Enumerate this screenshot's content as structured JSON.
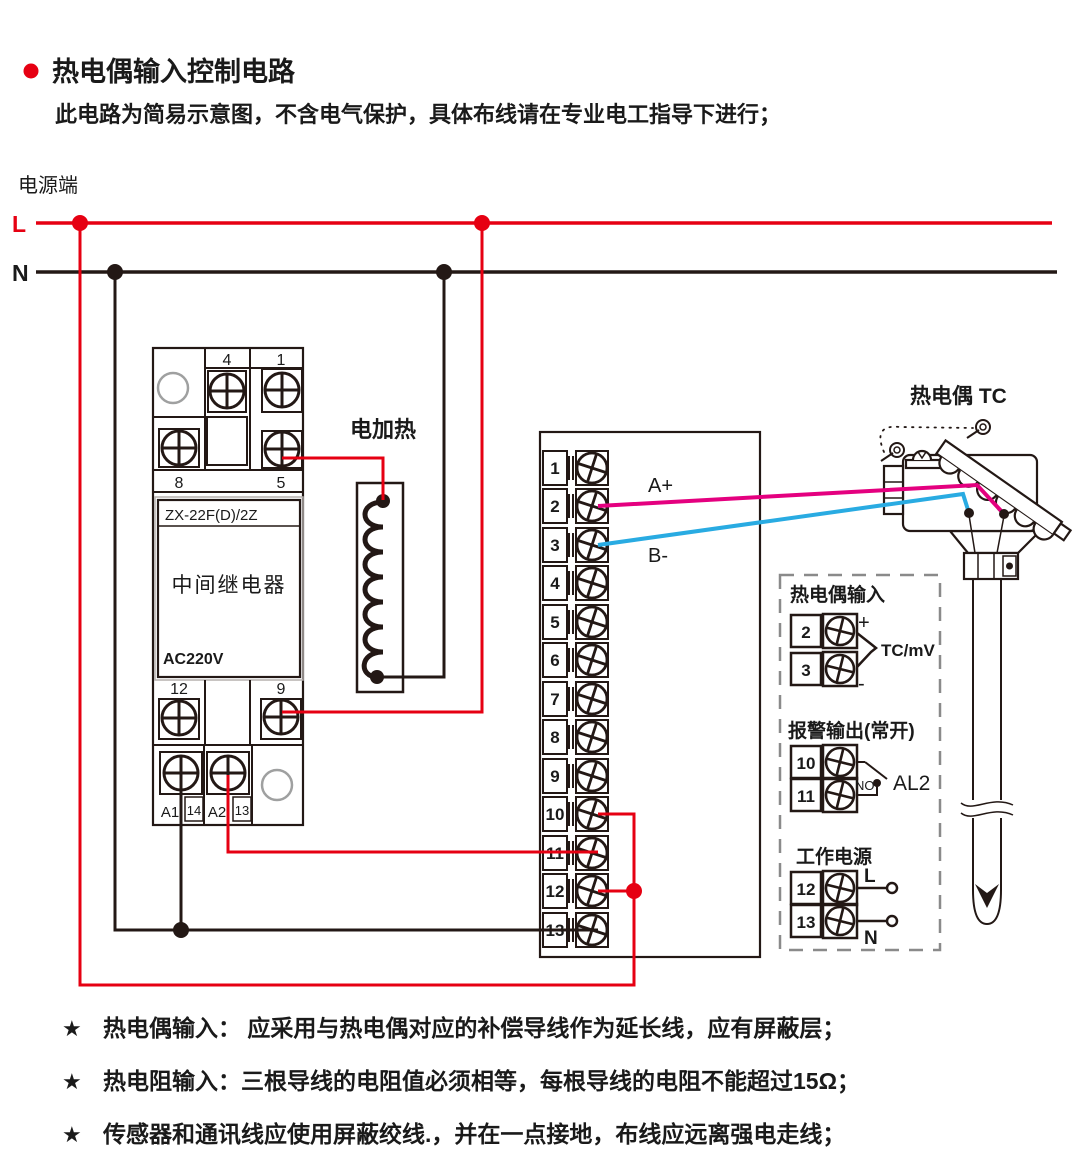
{
  "header": {
    "title": "热电偶输入控制电路",
    "subtitle": "此电路为简易示意图，不含电气保护，具体布线请在专业电工指导下进行；",
    "power_label": "电源端"
  },
  "rails": {
    "l": "L",
    "n": "N"
  },
  "relay": {
    "t4": "4",
    "t1": "1",
    "t8": "8",
    "t5": "5",
    "model": "ZX-22F(D)/2Z",
    "name": "中间继电器",
    "voltage": "AC220V",
    "t12": "12",
    "t9": "9",
    "a1": "A1",
    "n14": "14",
    "a2": "A2",
    "n13": "13"
  },
  "heater": {
    "label": "电加热"
  },
  "instrument": {
    "terminals": [
      "1",
      "2",
      "3",
      "4",
      "5",
      "6",
      "7",
      "8",
      "9",
      "10",
      "11",
      "12",
      "13"
    ],
    "a_plus": "A+",
    "b_minus": "B-"
  },
  "thermocouple": {
    "label": "热电偶 TC"
  },
  "panel": {
    "tc_input": {
      "title": "热电偶输入",
      "t2": "2",
      "t3": "3",
      "plus": "+",
      "minus": "-",
      "signal": "TC/mV"
    },
    "alarm": {
      "title": "报警输出(常开)",
      "t10": "10",
      "t11": "11",
      "no": "NO",
      "name": "AL2"
    },
    "power": {
      "title": "工作电源",
      "t12": "12",
      "t13": "13",
      "l": "L",
      "n": "N"
    }
  },
  "notes": [
    {
      "star": "★",
      "text": "热电偶输入： 应采用与热电偶对应的补偿导线作为延长线，应有屏蔽层；"
    },
    {
      "star": "★",
      "text": "热电阻输入：三根导线的电阻值必须相等，每根导线的电阻不能超过15Ω；"
    },
    {
      "star": "★",
      "text": "传感器和通讯线应使用屏蔽绞线.，并在一点接地，布线应远离强电走线；"
    }
  ],
  "colors": {
    "live_red": "#e60012",
    "signal_magenta": "#e4007f",
    "signal_blue": "#29abe2",
    "ink": "#231815"
  }
}
